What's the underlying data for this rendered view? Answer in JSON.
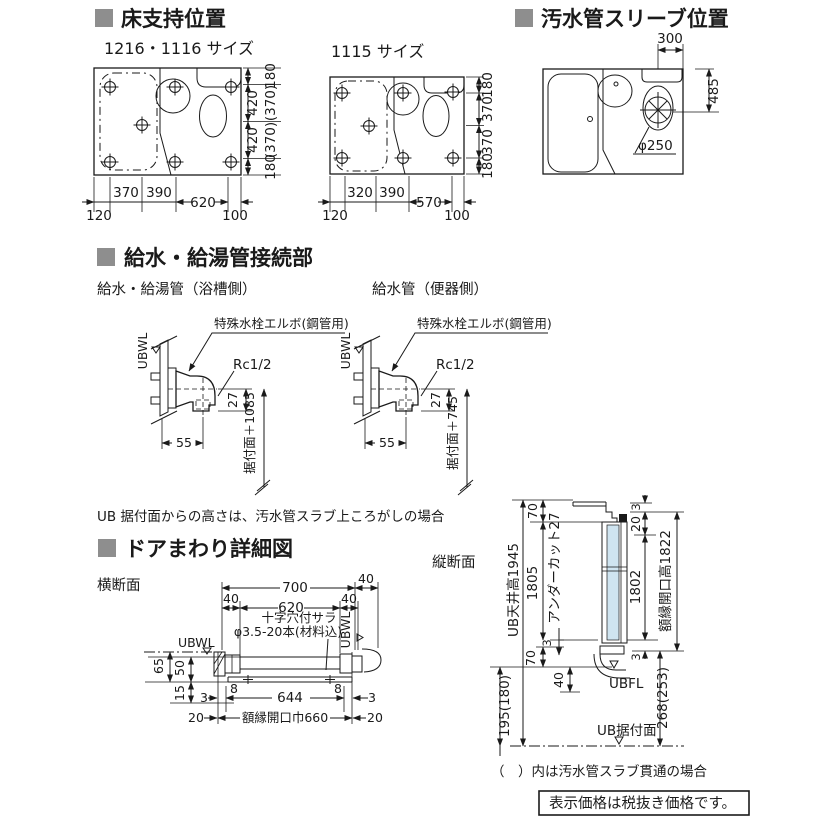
{
  "colors": {
    "ink": "#1a1a1a",
    "bullet": "#8e8e8e",
    "panel_blue": "#cfe4f0",
    "wall_gray": "#b3b3b3"
  },
  "titles": {
    "floor": "床支持位置",
    "sleeve": "汚水管スリーブ位置",
    "supply": "給水・給湯管接続部",
    "door": "ドアまわり詳細図"
  },
  "floor": {
    "plan_a": {
      "label": "1216・1116 サイズ",
      "d180": "180",
      "d420": "420",
      "d370p": "(370)",
      "b120": "120",
      "b370": "370",
      "b390": "390",
      "b620": "620",
      "b100": "100"
    },
    "plan_b": {
      "label": "1115 サイズ",
      "d180": "180",
      "d370": "370",
      "b120": "120",
      "b320": "320",
      "b390": "390",
      "b570": "570",
      "b100": "100"
    }
  },
  "sleeve": {
    "d300": "300",
    "d485": "485",
    "dia": "φ250"
  },
  "supply": {
    "bath_label": "給水・給湯管（浴槽側）",
    "toilet_label": "給水管（便器側）",
    "elbow": "特殊水栓エルボ(鋼管用)",
    "ubwl": "UBWL",
    "thread": "Rc1/2",
    "d27": "27",
    "d55": "55",
    "bath_height": "据付面＋1085",
    "toilet_height": "据付面＋745",
    "note": "UB 据付面からの高さは、汚水管スラブ上ころがしの場合"
  },
  "door": {
    "cross_label": "横断面",
    "vert_label": "縦断面",
    "cross": {
      "d700": "700",
      "d40": "40",
      "d620": "620",
      "screw1": "十字穴付サラ",
      "screw2": "φ3.5-20本(材料込)",
      "ubwl": "UBWL",
      "d65": "65",
      "d50": "50",
      "d15": "15",
      "d3": "3",
      "d8": "8",
      "d644": "644",
      "d20": "20",
      "opening": "額縁開口巾660"
    },
    "vert": {
      "ceiling": "UB天井高1945",
      "d70": "70",
      "d1805": "1805",
      "undercut": "アンダーカット27",
      "d3": "3",
      "d40": "40",
      "ubfl": "UBFL",
      "d195": "195(180)",
      "base": "UB据付面",
      "d20": "20",
      "d1802": "1802",
      "opening": "額縁開口高1822",
      "d268": "268(253)"
    }
  },
  "notes": {
    "paren": "（　）内は汚水管スラブ貫通の場合",
    "price": "表示価格は税抜き価格です。"
  }
}
